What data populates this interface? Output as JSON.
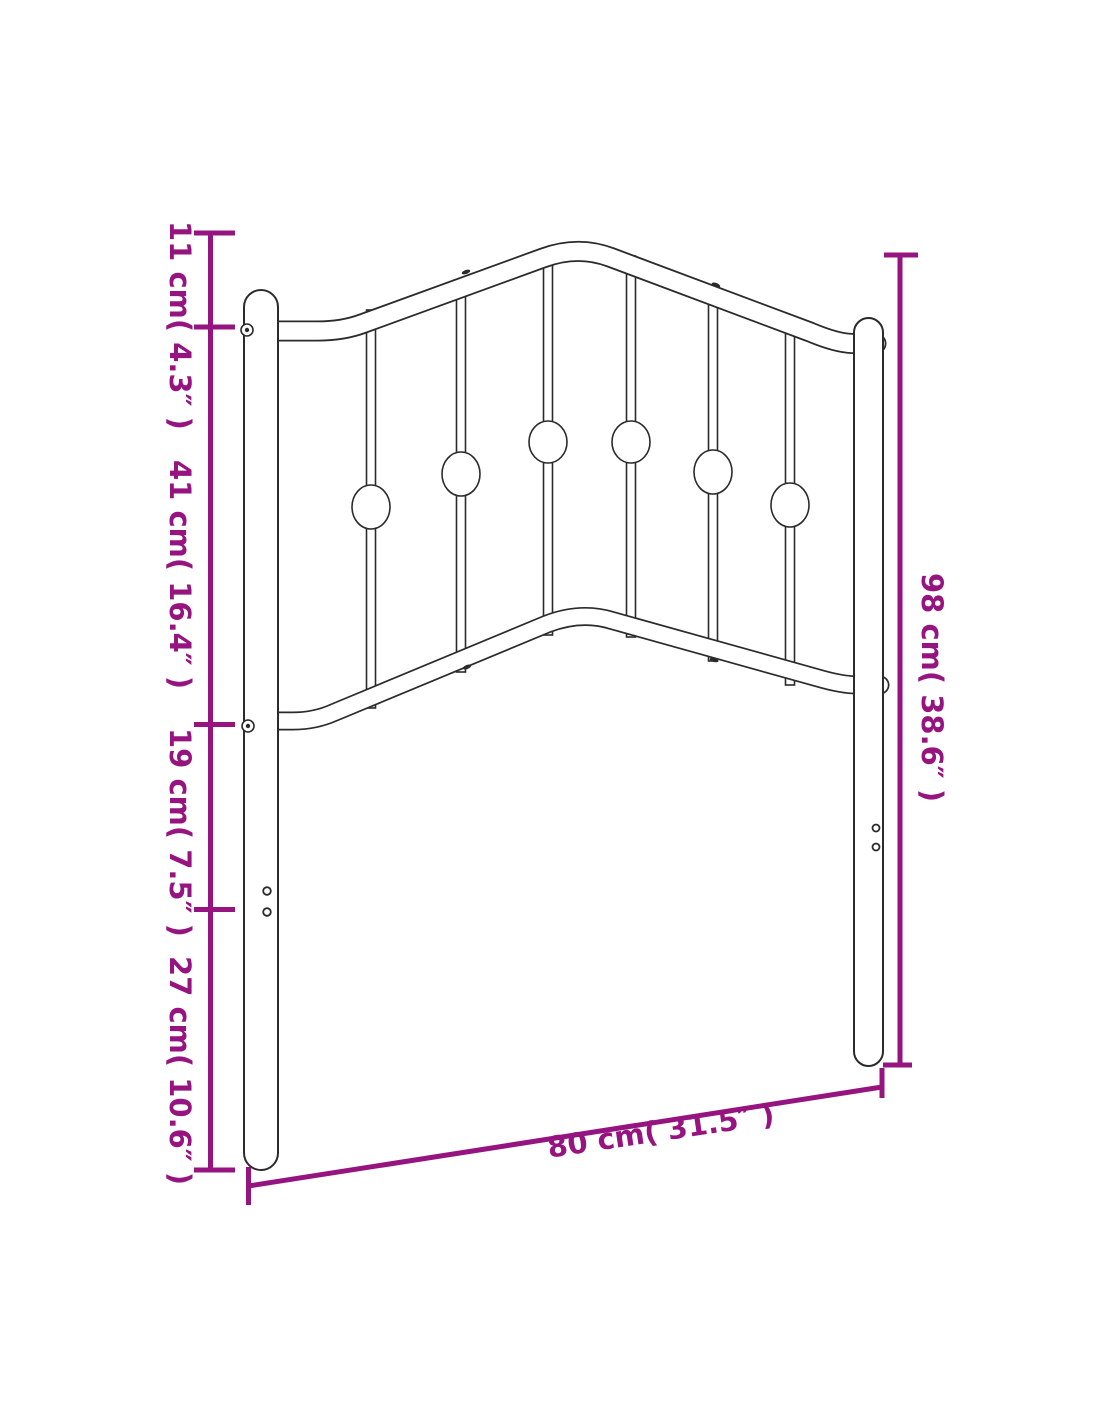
{
  "figure": {
    "name": "metal-headboard-dimension-diagram",
    "subject": "metal headboard line drawing with six balusters and decorative knobs"
  },
  "colors": {
    "dimension": "#961480",
    "outline": "#2b2b2b",
    "background": "#ffffff"
  },
  "dimensions": {
    "left": [
      {
        "label": "11 cm( 4.3″ )"
      },
      {
        "label": "41 cm( 16.4″ )"
      },
      {
        "label": "19 cm( 7.5″ )"
      },
      {
        "label": "27 cm( 10.6″ )"
      }
    ],
    "right": {
      "label": "98 cm( 38.6″ )"
    },
    "bottom": {
      "label": "80 cm( 31.5″ )"
    }
  }
}
